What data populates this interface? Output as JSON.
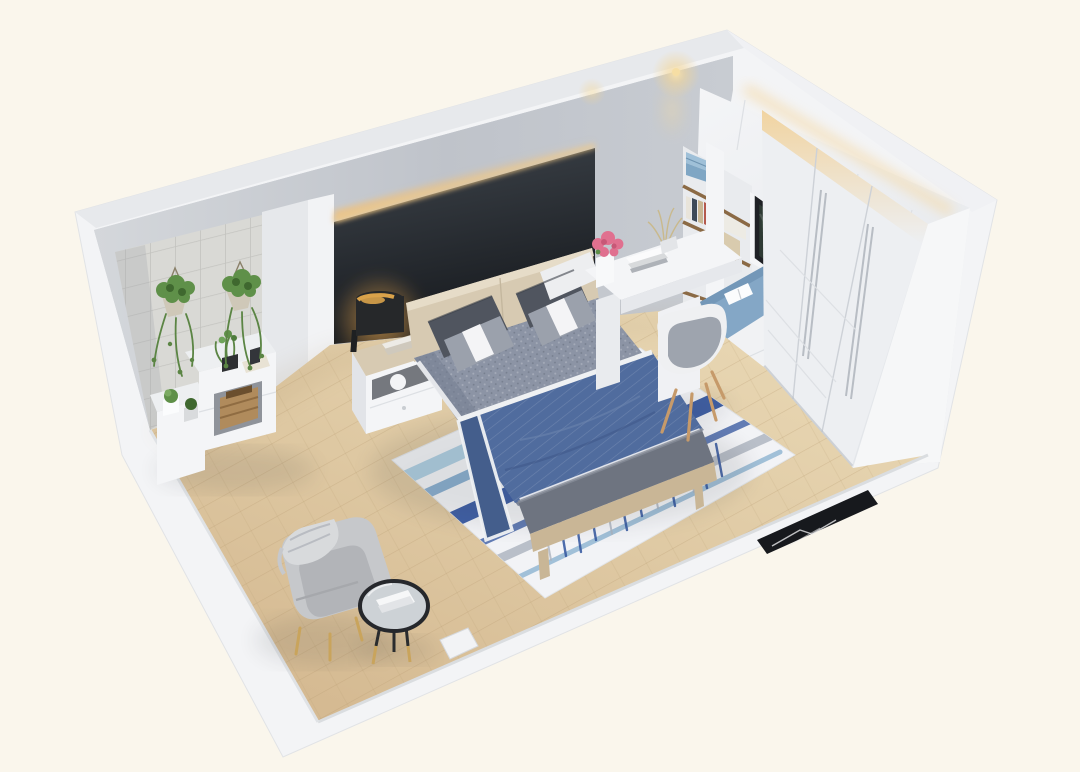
{
  "meta": {
    "title": "3D isometric cutaway render of a modern bedroom",
    "render_type": "interior-visualization",
    "view": "bird's-eye axonometric from the south-west, front walls cut away"
  },
  "palette": {
    "bg": "#FAF6EC",
    "shell": "#F3F4F6",
    "wallTopA": "#E7E9EC",
    "wallTopB": "#F0F1F4",
    "wallGreyDark": "#B9BDC5",
    "wallGreyLight": "#D6D9DD",
    "neWallLight": "#F2F3F5",
    "neWallDeep": "#DDE0E4",
    "accentTop": "#3E444B",
    "accentBottom": "#16191D",
    "ledGlow": "#EFC27E",
    "spotGlow": "#F6DEA4",
    "tileBase": "#D9D9D5",
    "tileLine": "#C3C3BF",
    "floorLight": "#E6D3AE",
    "floorDark": "#D2B68C",
    "plankLine": "#B89A72",
    "rugBase": "#F2F3F6",
    "rugNavy": "#31549E",
    "rugSteel": "#7FA9CC",
    "rugPale": "#A9CBE0",
    "rugGrey": "#AAB2BE",
    "duvet": "#8C94A5",
    "duvetShade": "#747D91",
    "throwBlue": "#506C9E",
    "throwDark": "#445E8C",
    "trimWhite": "#EFF1F3",
    "pillowDark": "#50555F",
    "pillowMid": "#9BA1AC",
    "pillowWhite": "#EDEEF0",
    "woodLight": "#D7CAB2",
    "woodMid": "#C9B696",
    "bench": "#6E7480",
    "furnWhite": "#F4F5F7",
    "furnWhite2": "#E4E6EA",
    "wardrobe": "#EDEFF2",
    "seamLine": "#CDD1D7",
    "softLine": "#DDE0E4",
    "seatCushion": "#84A7C6",
    "windowFrame": "#1F2125",
    "windowGlass": "#2E3A34",
    "shelfWood": "#8B6A45",
    "boxBlueLight": "#9FC0D8",
    "boxBlueDark": "#7FA6C4",
    "chairWood": "#C69A6A",
    "armchair": "#C6C8CB",
    "armchairDark": "#B2B4B8",
    "throwKnit": "#D8DADC",
    "gold": "#C9A45C",
    "tableRim": "#26282C",
    "tableTop": "#CDD2D6",
    "marble": "#17191D",
    "marbleVein": "#E8E9EB",
    "plantGreen": "#5F9049",
    "plantDark": "#3F682F",
    "plantVine": "#5B8544",
    "flowerPink": "#E0708F",
    "lampBlack": "#26282A",
    "lampGold": "#D9A24A"
  },
  "scene": {
    "room": "bedroom",
    "walls": {
      "north_west": "grey plaster wall with charcoal accent headboard panel, warm LED cove light along its top, grey tiled alcove section at the left",
      "north_east": "full-height white built-ins: upper cabinets with under-light, open bookshelf, black-framed window over a blue window-seat cushion, three-door white sliding wardrobe",
      "south_west": "low cut wall stub",
      "south_east": "low cut wall with door opening and black marble threshold"
    },
    "furniture": [
      {
        "name": "double-bed",
        "description": "light-oak platform bed, grey houndstooth duvet, navy pinstripe throw with white piping",
        "colors": [
          "duvet",
          "throwBlue",
          "woodLight"
        ]
      },
      {
        "name": "pillows",
        "description": "two charcoal pillows and two grey pillows with white accent bands",
        "colors": [
          "pillowDark",
          "pillowMid",
          "pillowWhite"
        ]
      },
      {
        "name": "foot-bench",
        "description": "grey upholstered bench on oak base at foot of bed",
        "colors": [
          "bench",
          "woodMid"
        ]
      },
      {
        "name": "area-rug",
        "description": "white rug with indigo and steel-blue ikat brush streaks",
        "colors": [
          "rugBase",
          "rugNavy",
          "rugSteel",
          "rugPale"
        ]
      },
      {
        "name": "nightstand",
        "description": "white drawer nightstand with oak top, books and sphere ornament",
        "colors": [
          "furnWhite",
          "woodLight"
        ]
      },
      {
        "name": "table-lamp",
        "description": "black cylinder lamp with warm gold interior glow",
        "colors": [
          "lampBlack",
          "lampGold"
        ]
      },
      {
        "name": "study-desk",
        "description": "white L-shaped desk with books, pink flower vase and dried grass",
        "colors": [
          "furnWhite",
          "flowerPink"
        ]
      },
      {
        "name": "desk-chair",
        "description": "white shell chair, grey pad, splayed oak legs",
        "colors": [
          "furnWhite",
          "pillowMid",
          "chairWood"
        ]
      },
      {
        "name": "bookshelf",
        "description": "open niche shelving with books, bowls and two blue storage boxes",
        "colors": [
          "shelfWood",
          "boxBlueLight",
          "boxBlueDark"
        ]
      },
      {
        "name": "window-seat",
        "description": "built-in bay seat with blue cushion and open white book",
        "colors": [
          "seatCushion",
          "trimWhite"
        ]
      },
      {
        "name": "wardrobe",
        "description": "three-door white sliding wardrobe with slim vertical handles and warm cove light above",
        "colors": [
          "wardrobe",
          "ledGlow"
        ]
      },
      {
        "name": "armchair",
        "description": "light grey fabric armchair with draped knit throw, gold legs",
        "colors": [
          "armchair",
          "throwKnit",
          "gold"
        ]
      },
      {
        "name": "coffee-table",
        "description": "round mirror-top side table, black rim, gold legs, white book tray",
        "colors": [
          "tableRim",
          "tableTop",
          "gold"
        ]
      },
      {
        "name": "storage-cabinets",
        "description": "stepped white cabinets in tiled alcove with wooden crate, succulents and potted sprigs",
        "colors": [
          "furnWhite",
          "shelfWood"
        ]
      },
      {
        "name": "hanging-plants",
        "description": "two rope-hung planters with trailing green vines on the tile wall",
        "colors": [
          "plantGreen",
          "plantDark"
        ]
      },
      {
        "name": "marble-threshold",
        "description": "black marble doorway threshold strip with white veining",
        "colors": [
          "marble",
          "marbleVein"
        ]
      },
      {
        "name": "ceiling-spotlight",
        "description": "warm recessed downlights glowing near the inner corner",
        "colors": [
          "spotGlow"
        ]
      }
    ],
    "floor": {
      "name": "wood-floor",
      "description": "light oak planks laid diagonally",
      "colors": [
        "floorLight",
        "floorDark"
      ]
    }
  }
}
